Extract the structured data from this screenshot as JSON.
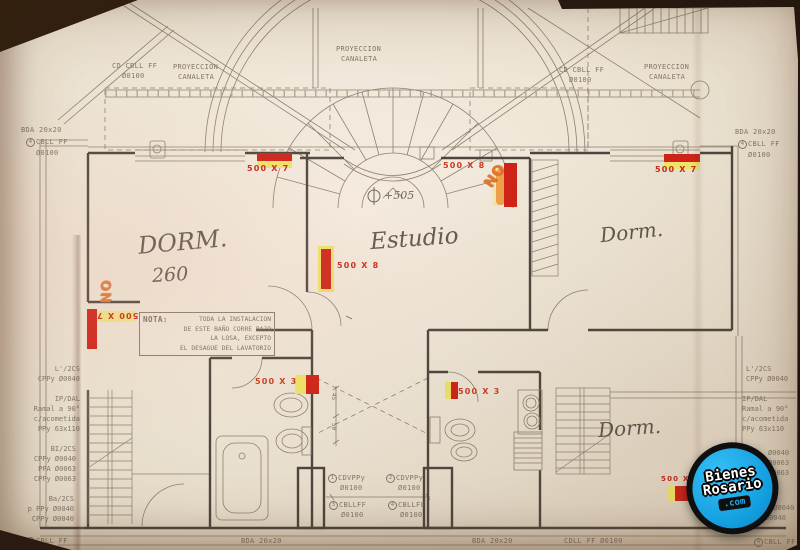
{
  "top": {
    "cbll_left": {
      "l1": "CD CBLL FF",
      "l2": "Ø0100"
    },
    "proy_left": {
      "l1": "PROYECCION",
      "l2": "CANALETA"
    },
    "proy_center": {
      "l1": "PROYECCION",
      "l2": "CANALETA"
    },
    "cbll_right": {
      "l1": "CD CBLL FF",
      "l2": "Ø0100"
    },
    "proy_right": {
      "l1": "PROYECCION",
      "l2": "CANALETA"
    }
  },
  "left_side": {
    "bda": "BDA 20x20",
    "cbll": {
      "num": "4",
      "text": "CBLL FF",
      "dia": "Ø0100"
    },
    "l2cs": "L'/2CS\nCPPy Ø0040",
    "ipdal": "IP/DAL\nRamal a 90°\nc/acometida\nPPy 63x110",
    "bi2cs": "BI/2CS\nCPPy Ø0040\nPPA Ø0063\nCPPy Ø0063",
    "ba2cs": "Ba/2CS\np PPy Ø0040\nCPPy Ø0040",
    "cbll_bottom": {
      "num": "4",
      "text": "CBLL FF"
    }
  },
  "right_side": {
    "bda": "BDA 20x20",
    "cbll": {
      "num": "4",
      "text": "CBLL FF",
      "dia": "Ø0100"
    },
    "l2cs": "L'/2CS\nCPPy Ø0040",
    "ipdal": "IP/DAL\nRamal a 90°\nc/acometida\nPPy 63x110",
    "partial1": "Ø0040\nØ0063\nØ0063",
    "partial2": "p PPy Ø0040\nPPy Ø0040",
    "cbll_bottom": {
      "num": "4",
      "text": "CBLL FF"
    }
  },
  "rooms": {
    "dorm_left": {
      "name": "DORM.",
      "number": "260"
    },
    "estudio": {
      "name": "Estudio",
      "level": "+505"
    },
    "dorm_right": {
      "name": "Dorm."
    },
    "dorm_bottom": {
      "name": "Dorm."
    }
  },
  "markers": {
    "m_dorm_top": "500 X 7",
    "m_estudio_top": "500 X 8",
    "m_estudio_left": "500 X 8",
    "m_dorm_right_top": "500 X 7",
    "m_left_wall": "500 X 7",
    "m_bath_left": "500 X 3",
    "m_bath_right": "500 X 3",
    "m_bottom_right": "500 X",
    "no_center": "NO",
    "no_left": "NO"
  },
  "nota": {
    "title": "NOTA:",
    "line1": "TODA LA INSTALACION",
    "line2": "DE ESTE BAÑO CORRE BAJO",
    "line3": "LA LOSA, EXCEPTO",
    "line4": "EL DESAGUE DEL LAVATORIO"
  },
  "bottom": {
    "cdv1": {
      "num": "1",
      "text": "CDVPPy",
      "dia": "Ø0100"
    },
    "cdv2": {
      "num": "2",
      "text": "CDVPPy",
      "dia": "Ø0100"
    },
    "cbl3": {
      "num": "3",
      "text": "CBLLFF",
      "dia": "Ø0100"
    },
    "cbl4": {
      "num": "4",
      "text": "CBLLFF",
      "dia": "Ø0100"
    },
    "bda1": "BDA 20x20",
    "bda2": "BDA 20x20",
    "cdll": "CDLL FF Ø0100"
  },
  "dims": {
    "d45": "45",
    "d50": "50"
  },
  "watermark": {
    "line1": "Bienes",
    "line2": "Rosario",
    "badge": ".com"
  },
  "colors": {
    "marker_red": "#cf2318",
    "marker_yellow": "#f0e46a",
    "note_orange": "#e0782c",
    "logo_blue": "#1ba9ea",
    "paper": "#ece3d4"
  }
}
